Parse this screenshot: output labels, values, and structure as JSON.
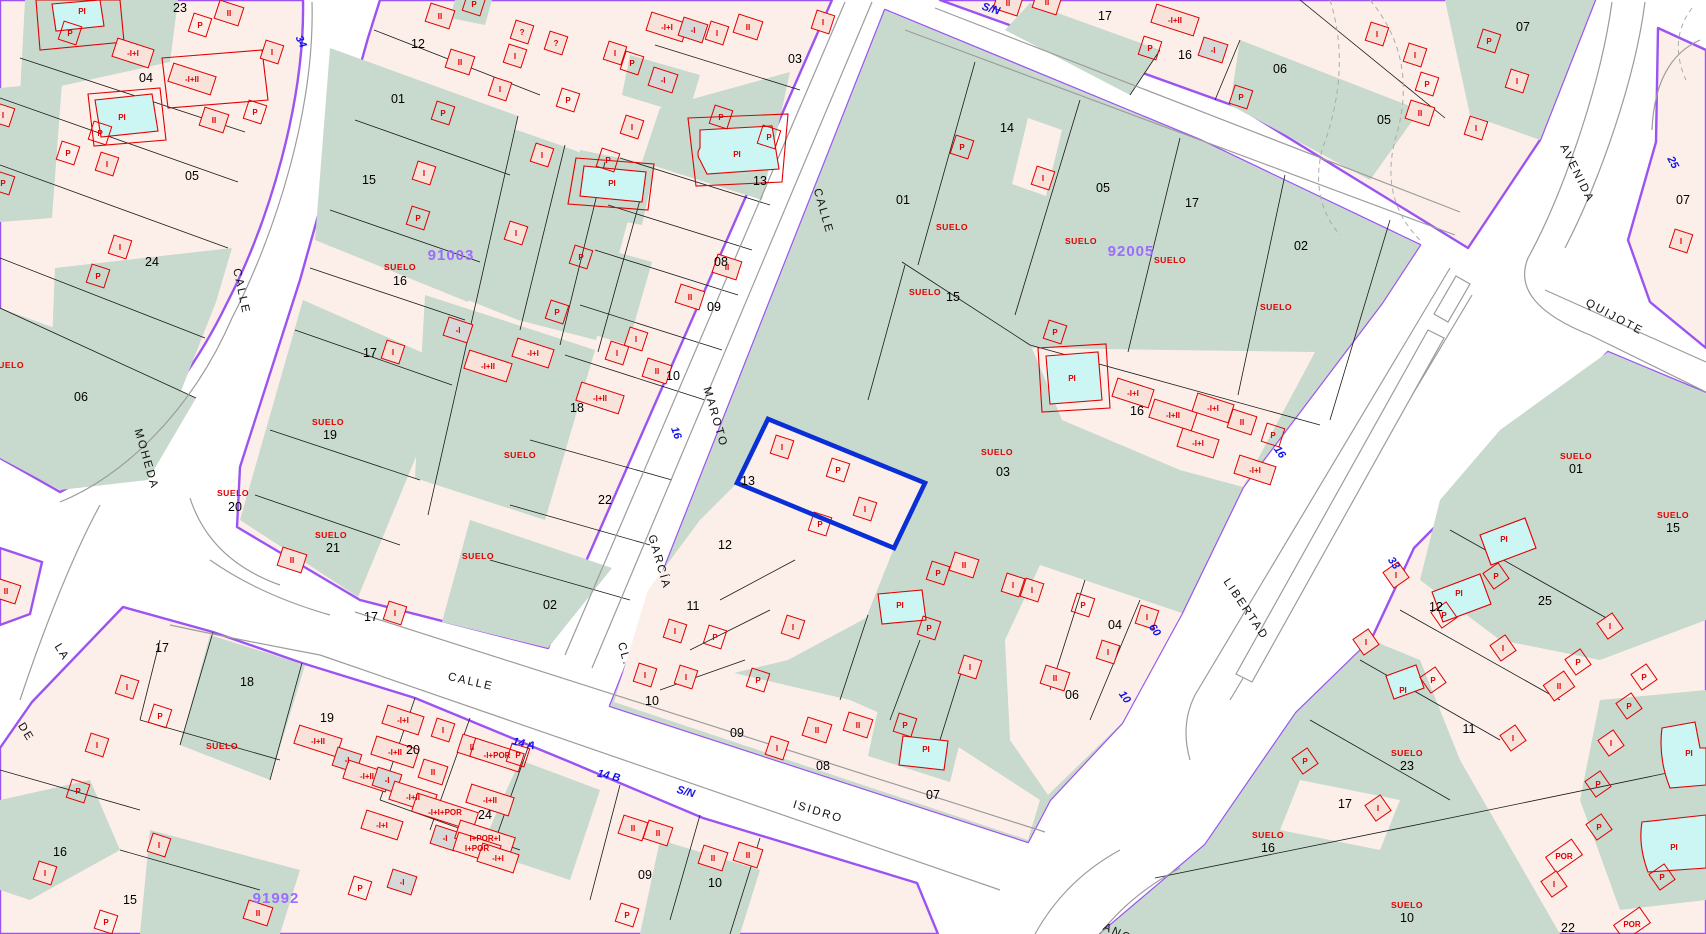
{
  "map": {
    "title": "cadastral-parcel-map",
    "selected_parcel": "13",
    "suelo_text": "SUELO",
    "colors": {
      "parcel_pink": "#FCEFE9",
      "building_pink": "#F8E2DA",
      "green_suelo": "#C8D9CD",
      "pool_cyan": "#CBF6F4",
      "gray_building": "#D8D8D8",
      "construction_red": "#E00000",
      "street_edge_purple": "#9B53F2",
      "road_gray": "#9C9C9C",
      "selection_blue": "#0A2FD6",
      "address_blue": "#1414E6",
      "block_number_purple": "#9B6CFF"
    },
    "block_numbers": [
      [
        "91003",
        451,
        260
      ],
      [
        "92005",
        1131,
        256
      ],
      [
        "91992",
        276,
        903
      ]
    ],
    "street_labels": [
      [
        "CALLE",
        238,
        292,
        78
      ],
      [
        "MOHEDA",
        143,
        460,
        74
      ],
      [
        "LA",
        59,
        654,
        58
      ],
      [
        "DE",
        23,
        734,
        58
      ],
      [
        "CALLE",
        820,
        212,
        74
      ],
      [
        "MAROTO",
        712,
        418,
        74
      ],
      [
        "GARCÍA",
        656,
        563,
        74
      ],
      [
        "CL.",
        621,
        655,
        74
      ],
      [
        "CALLE",
        470,
        685,
        13
      ],
      [
        "ISIDRO",
        817,
        815,
        17
      ],
      [
        "LIBERTAD",
        1243,
        611,
        56
      ],
      [
        "AVENIDA",
        1574,
        175,
        64
      ],
      [
        "QUIJOTE",
        1613,
        320,
        28
      ],
      [
        "ANCHA",
        1125,
        940,
        25
      ]
    ],
    "address_labels": [
      [
        "34",
        298,
        39,
        65
      ],
      [
        "S/N",
        990,
        8,
        17
      ],
      [
        "16",
        673,
        430,
        70
      ],
      [
        "14 A",
        523,
        743,
        13
      ],
      [
        "14 B",
        608,
        775,
        13
      ],
      [
        "S/N",
        685,
        791,
        15
      ],
      [
        "16",
        1277,
        450,
        55
      ],
      [
        "60",
        1152,
        628,
        55
      ],
      [
        "10",
        1122,
        695,
        55
      ],
      [
        "33",
        1391,
        561,
        55
      ],
      [
        "25",
        1670,
        160,
        62
      ]
    ],
    "parcel_numbers": [
      [
        "23",
        180,
        8
      ],
      [
        "04",
        146,
        78
      ],
      [
        "05",
        192,
        176
      ],
      [
        "24",
        152,
        262
      ],
      [
        "06",
        81,
        397
      ],
      [
        "12",
        418,
        44
      ],
      [
        "01",
        398,
        99
      ],
      [
        "15",
        369,
        180
      ],
      [
        "16",
        400,
        281
      ],
      [
        "17",
        370,
        353
      ],
      [
        "19",
        330,
        435
      ],
      [
        "20",
        235,
        507
      ],
      [
        "21",
        333,
        548
      ],
      [
        "22",
        605,
        500
      ],
      [
        "02",
        550,
        605
      ],
      [
        "18",
        577,
        408
      ],
      [
        "03",
        795,
        59
      ],
      [
        "13",
        760,
        181
      ],
      [
        "08",
        721,
        262
      ],
      [
        "09",
        714,
        307
      ],
      [
        "10",
        673,
        376
      ],
      [
        "01",
        903,
        200
      ],
      [
        "14",
        1007,
        128
      ],
      [
        "05",
        1103,
        188
      ],
      [
        "17",
        1192,
        203
      ],
      [
        "02",
        1301,
        246
      ],
      [
        "15",
        953,
        297
      ],
      [
        "16",
        1137,
        411
      ],
      [
        "03",
        1003,
        472
      ],
      [
        "13",
        748,
        481
      ],
      [
        "12",
        725,
        545
      ],
      [
        "11",
        693,
        606
      ],
      [
        "10",
        652,
        701
      ],
      [
        "09",
        737,
        733
      ],
      [
        "08",
        823,
        766
      ],
      [
        "07",
        933,
        795
      ],
      [
        "04",
        1115,
        625
      ],
      [
        "06",
        1072,
        695
      ],
      [
        "17",
        1105,
        16
      ],
      [
        "16",
        1185,
        55
      ],
      [
        "06",
        1280,
        69
      ],
      [
        "05",
        1384,
        120
      ],
      [
        "07",
        1523,
        27
      ],
      [
        "07",
        1683,
        200
      ],
      [
        "01",
        1576,
        469
      ],
      [
        "15",
        1673,
        528
      ],
      [
        "12",
        1436,
        607
      ],
      [
        "25",
        1545,
        601
      ],
      [
        "11",
        1469,
        729
      ],
      [
        "23",
        1407,
        766
      ],
      [
        "17",
        1345,
        804
      ],
      [
        "10",
        1407,
        918
      ],
      [
        "22",
        1568,
        928
      ],
      [
        "16",
        1268,
        848
      ],
      [
        "17",
        162,
        648
      ],
      [
        "18",
        247,
        682
      ],
      [
        "19",
        327,
        718
      ],
      [
        "20",
        413,
        750
      ],
      [
        "24",
        485,
        815
      ],
      [
        "16",
        60,
        852
      ],
      [
        "15",
        130,
        900
      ],
      [
        "09",
        645,
        875
      ],
      [
        "10",
        715,
        883
      ],
      [
        "17",
        371,
        617
      ]
    ],
    "suelo_positions": [
      [
        8,
        365
      ],
      [
        400,
        267
      ],
      [
        328,
        422
      ],
      [
        233,
        493
      ],
      [
        331,
        535
      ],
      [
        520,
        455
      ],
      [
        478,
        556
      ],
      [
        952,
        227
      ],
      [
        1081,
        241
      ],
      [
        1170,
        260
      ],
      [
        1276,
        307
      ],
      [
        925,
        292
      ],
      [
        997,
        452
      ],
      [
        222,
        746
      ],
      [
        1576,
        456
      ],
      [
        1673,
        515
      ],
      [
        1407,
        753
      ],
      [
        1407,
        905
      ],
      [
        1268,
        835
      ]
    ],
    "construction_labels": [
      [
        "P",
        200,
        28
      ],
      [
        "PI",
        82,
        14,
        18,
        "q"
      ],
      [
        "P",
        70,
        36
      ],
      [
        "-I+I",
        133,
        56
      ],
      [
        "-I+II",
        192,
        82
      ],
      [
        "II",
        229,
        16
      ],
      [
        "I",
        272,
        55
      ],
      [
        "II",
        214,
        123
      ],
      [
        "P",
        255,
        115
      ],
      [
        "PI",
        122,
        120,
        18,
        "q"
      ],
      [
        "P",
        100,
        136
      ],
      [
        "I",
        107,
        167
      ],
      [
        "P",
        68,
        156
      ],
      [
        "I",
        120,
        250
      ],
      [
        "P",
        98,
        279
      ],
      [
        "I",
        3,
        118
      ],
      [
        "P",
        3,
        186
      ],
      [
        "P",
        474,
        7
      ],
      [
        "II",
        440,
        19
      ],
      [
        "?",
        522,
        35
      ],
      [
        "?",
        556,
        46
      ],
      [
        "I",
        515,
        59
      ],
      [
        "II",
        460,
        65
      ],
      [
        "I",
        500,
        92
      ],
      [
        "-I+I",
        667,
        30
      ],
      [
        "-I",
        693,
        33
      ],
      [
        "I",
        717,
        36
      ],
      [
        "II",
        748,
        30
      ],
      [
        "I",
        615,
        56
      ],
      [
        "P",
        632,
        66
      ],
      [
        "-I",
        663,
        83
      ],
      [
        "I",
        823,
        25
      ],
      [
        "P",
        568,
        103
      ],
      [
        "I",
        632,
        130
      ],
      [
        "P",
        443,
        116
      ],
      [
        "I",
        424,
        176
      ],
      [
        "P",
        418,
        221
      ],
      [
        "I",
        542,
        158
      ],
      [
        "P",
        608,
        163
      ],
      [
        "PI",
        612,
        186,
        18,
        "q"
      ],
      [
        "P",
        721,
        120
      ],
      [
        "P",
        769,
        140
      ],
      [
        "PI",
        737,
        157,
        18,
        "q"
      ],
      [
        "I",
        516,
        236
      ],
      [
        "P",
        581,
        260
      ],
      [
        "P",
        557,
        315
      ],
      [
        "-I+I",
        533,
        356
      ],
      [
        "I",
        617,
        356
      ],
      [
        "II",
        690,
        300
      ],
      [
        "II",
        727,
        270
      ],
      [
        "II",
        657,
        374
      ],
      [
        "I",
        636,
        342
      ],
      [
        "-I",
        458,
        333
      ],
      [
        "-I+II",
        600,
        401
      ],
      [
        "-I+II",
        488,
        369
      ],
      [
        "I",
        393,
        355
      ],
      [
        "II",
        292,
        563
      ],
      [
        "P",
        962,
        150
      ],
      [
        "I",
        1043,
        181
      ],
      [
        "P",
        1055,
        335
      ],
      [
        "PI",
        1072,
        381,
        18,
        "q"
      ],
      [
        "-I+I",
        1133,
        396
      ],
      [
        "-I+II",
        1173,
        418
      ],
      [
        "-I+I",
        1213,
        411
      ],
      [
        "II",
        1242,
        425
      ],
      [
        "-I+I",
        1198,
        446
      ],
      [
        "-I+I",
        1255,
        473
      ],
      [
        "P",
        1273,
        438
      ],
      [
        "I",
        782,
        450
      ],
      [
        "P",
        838,
        473
      ],
      [
        "I",
        865,
        512
      ],
      [
        "P",
        820,
        527
      ],
      [
        "P",
        938,
        576
      ],
      [
        "II",
        964,
        568
      ],
      [
        "I",
        793,
        630
      ],
      [
        "P",
        758,
        683
      ],
      [
        "P",
        715,
        640
      ],
      [
        "I",
        675,
        634
      ],
      [
        "I",
        686,
        680
      ],
      [
        "I",
        645,
        678
      ],
      [
        "II",
        817,
        733
      ],
      [
        "I",
        777,
        751
      ],
      [
        "II",
        858,
        728
      ],
      [
        "P",
        905,
        728
      ],
      [
        "PI",
        900,
        608,
        18,
        "q"
      ],
      [
        "P",
        929,
        631
      ],
      [
        "PI",
        926,
        752,
        18,
        "q"
      ],
      [
        "I",
        970,
        670
      ],
      [
        "I",
        1013,
        588
      ],
      [
        "I",
        1032,
        593
      ],
      [
        "P",
        1083,
        608
      ],
      [
        "I",
        1147,
        620
      ],
      [
        "I",
        1108,
        655
      ],
      [
        "II",
        1055,
        681
      ],
      [
        "II",
        1008,
        6
      ],
      [
        "II",
        1047,
        5
      ],
      [
        "-I+II",
        1175,
        23
      ],
      [
        "P",
        1150,
        51
      ],
      [
        "-I",
        1213,
        53
      ],
      [
        "P",
        1241,
        100
      ],
      [
        "I",
        1377,
        37
      ],
      [
        "I",
        1415,
        58
      ],
      [
        "P",
        1427,
        87
      ],
      [
        "II",
        1420,
        116
      ],
      [
        "I",
        1476,
        131
      ],
      [
        "I",
        1517,
        84
      ],
      [
        "P",
        1489,
        44
      ],
      [
        "I",
        1681,
        244
      ],
      [
        "PI",
        1504,
        542,
        -35,
        "q"
      ],
      [
        "P",
        1496,
        579,
        -35
      ],
      [
        "PI",
        1459,
        596,
        -35,
        "q"
      ],
      [
        "P",
        1444,
        618,
        -35
      ],
      [
        "I",
        1396,
        578,
        -35
      ],
      [
        "I",
        1366,
        645,
        -35
      ],
      [
        "PI",
        1403,
        693,
        -35,
        "q"
      ],
      [
        "P",
        1433,
        683,
        -35
      ],
      [
        "I",
        1513,
        741,
        -35
      ],
      [
        "P",
        1305,
        764,
        -35
      ],
      [
        "I",
        1378,
        811,
        -35
      ],
      [
        "II",
        1559,
        689,
        -35
      ],
      [
        "I",
        1503,
        651,
        -35
      ],
      [
        "I",
        1610,
        629,
        -35
      ],
      [
        "P",
        1578,
        665,
        -35
      ],
      [
        "P",
        1644,
        680,
        -35
      ],
      [
        "P",
        1629,
        709,
        -35
      ],
      [
        "I",
        1611,
        746,
        -35
      ],
      [
        "P",
        1598,
        787,
        -35
      ],
      [
        "P",
        1599,
        830,
        -35
      ],
      [
        "POR",
        1564,
        859,
        -35
      ],
      [
        "I",
        1554,
        887,
        -35
      ],
      [
        "PI",
        1689,
        756,
        -35,
        "q"
      ],
      [
        "PI",
        1674,
        850,
        -35,
        "q"
      ],
      [
        "P",
        1662,
        880,
        -35
      ],
      [
        "POR",
        1632,
        927,
        -35
      ],
      [
        "I",
        127,
        690
      ],
      [
        "I",
        45,
        876
      ],
      [
        "I",
        159,
        848
      ],
      [
        "P",
        78,
        794
      ],
      [
        "P",
        160,
        719
      ],
      [
        "I",
        97,
        748
      ],
      [
        "P",
        106,
        925
      ],
      [
        "II",
        258,
        916
      ],
      [
        "I",
        395,
        616
      ],
      [
        "-I+II",
        318,
        744
      ],
      [
        "-I+I",
        403,
        723
      ],
      [
        "-I+II",
        395,
        755
      ],
      [
        "-I",
        347,
        763
      ],
      [
        "-I+II",
        367,
        779
      ],
      [
        "-I",
        387,
        783
      ],
      [
        "II",
        433,
        775
      ],
      [
        "I",
        443,
        733
      ],
      [
        "II",
        472,
        750
      ],
      [
        "-I+II",
        413,
        800
      ],
      [
        "-I+I+POR",
        445,
        815
      ],
      [
        "-I+II",
        490,
        803
      ],
      [
        "-I",
        445,
        841
      ],
      [
        "I+POR+I",
        485,
        841
      ],
      [
        "I+POR",
        477,
        851
      ],
      [
        "-I+I",
        498,
        861
      ],
      [
        "-I+POR",
        497,
        758
      ],
      [
        "P",
        518,
        758
      ],
      [
        "-I+I",
        382,
        828
      ],
      [
        "-I",
        402,
        885
      ],
      [
        "P",
        360,
        891
      ],
      [
        "II",
        633,
        831
      ],
      [
        "II",
        658,
        836
      ],
      [
        "II",
        713,
        861
      ],
      [
        "II",
        748,
        858
      ],
      [
        "P",
        627,
        918
      ],
      [
        "II",
        6,
        594
      ]
    ]
  }
}
